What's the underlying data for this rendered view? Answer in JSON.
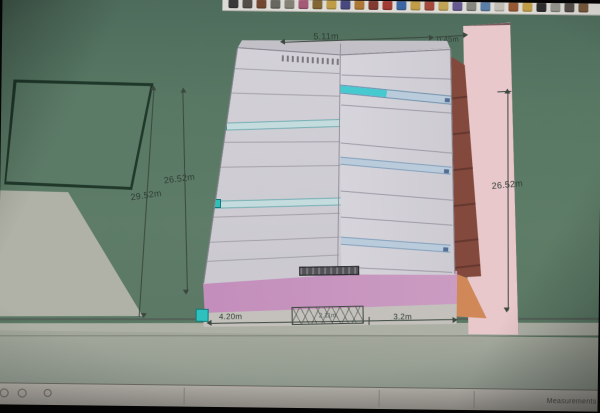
{
  "annotations": {
    "top_width": "5.11m",
    "top_offset": "0.45m",
    "left_outer_height": "29.52m",
    "left_inner_height": "26.52m",
    "right_height": "26.52m",
    "bottom_left_width": "4.20m",
    "bottom_mid_note": "2.11m",
    "bottom_right_width": "3.2m"
  },
  "status_bar": {
    "measurements_label": "Measurements"
  },
  "toolbar": {
    "icons": [
      {
        "name": "select-tool-icon",
        "color": "#3a3a3a"
      },
      {
        "name": "line-tool-icon",
        "color": "#555048"
      },
      {
        "name": "rectangle-tool-icon",
        "color": "#7a4a2e"
      },
      {
        "name": "circle-tool-icon",
        "color": "#6a6a62"
      },
      {
        "name": "arc-tool-icon",
        "color": "#8a8578"
      },
      {
        "name": "eraser-tool-icon",
        "color": "#b05a7a"
      },
      {
        "name": "tape-measure-icon",
        "color": "#8a6a2e"
      },
      {
        "name": "protractor-icon",
        "color": "#c8a23e"
      },
      {
        "name": "text-tool-icon",
        "color": "#4a4a8a"
      },
      {
        "name": "paint-bucket-icon",
        "color": "#b87a2e"
      },
      {
        "name": "push-pull-icon",
        "color": "#8a3a2e"
      },
      {
        "name": "move-tool-icon",
        "color": "#b03a32"
      },
      {
        "name": "rotate-tool-icon",
        "color": "#3a6ab0"
      },
      {
        "name": "offset-tool-icon",
        "color": "#caa23e"
      },
      {
        "name": "orbit-tool-icon",
        "color": "#b04a3a"
      },
      {
        "name": "pan-tool-icon",
        "color": "#caa84e"
      },
      {
        "name": "zoom-tool-icon",
        "color": "#6a5a9a"
      },
      {
        "name": "zoom-extents-icon",
        "color": "#8a8a82"
      },
      {
        "name": "previous-view-icon",
        "color": "#5a82b0"
      },
      {
        "name": "next-view-icon",
        "color": "#c6c2b8"
      },
      {
        "name": "position-camera-icon",
        "color": "#a05a2e"
      },
      {
        "name": "look-around-icon",
        "color": "#caa23e"
      },
      {
        "name": "walk-tool-icon",
        "color": "#2e2e2e"
      },
      {
        "name": "section-plane-icon",
        "color": "#9a9a92"
      },
      {
        "name": "shadows-icon",
        "color": "#58504a"
      },
      {
        "name": "model-info-icon",
        "color": "#7e5a3a"
      }
    ]
  },
  "colors": {
    "ground_green": "#5b7f69",
    "facade_gray": "#d8d5dd",
    "selection_teal": "#22cbc6",
    "band_blue": "#bed3e4",
    "brick_red": "#8c4a3c",
    "podium_pink": "#cf92c4",
    "slab_pink": "#f2cdd0",
    "wedge_orange": "#dd8b55"
  }
}
